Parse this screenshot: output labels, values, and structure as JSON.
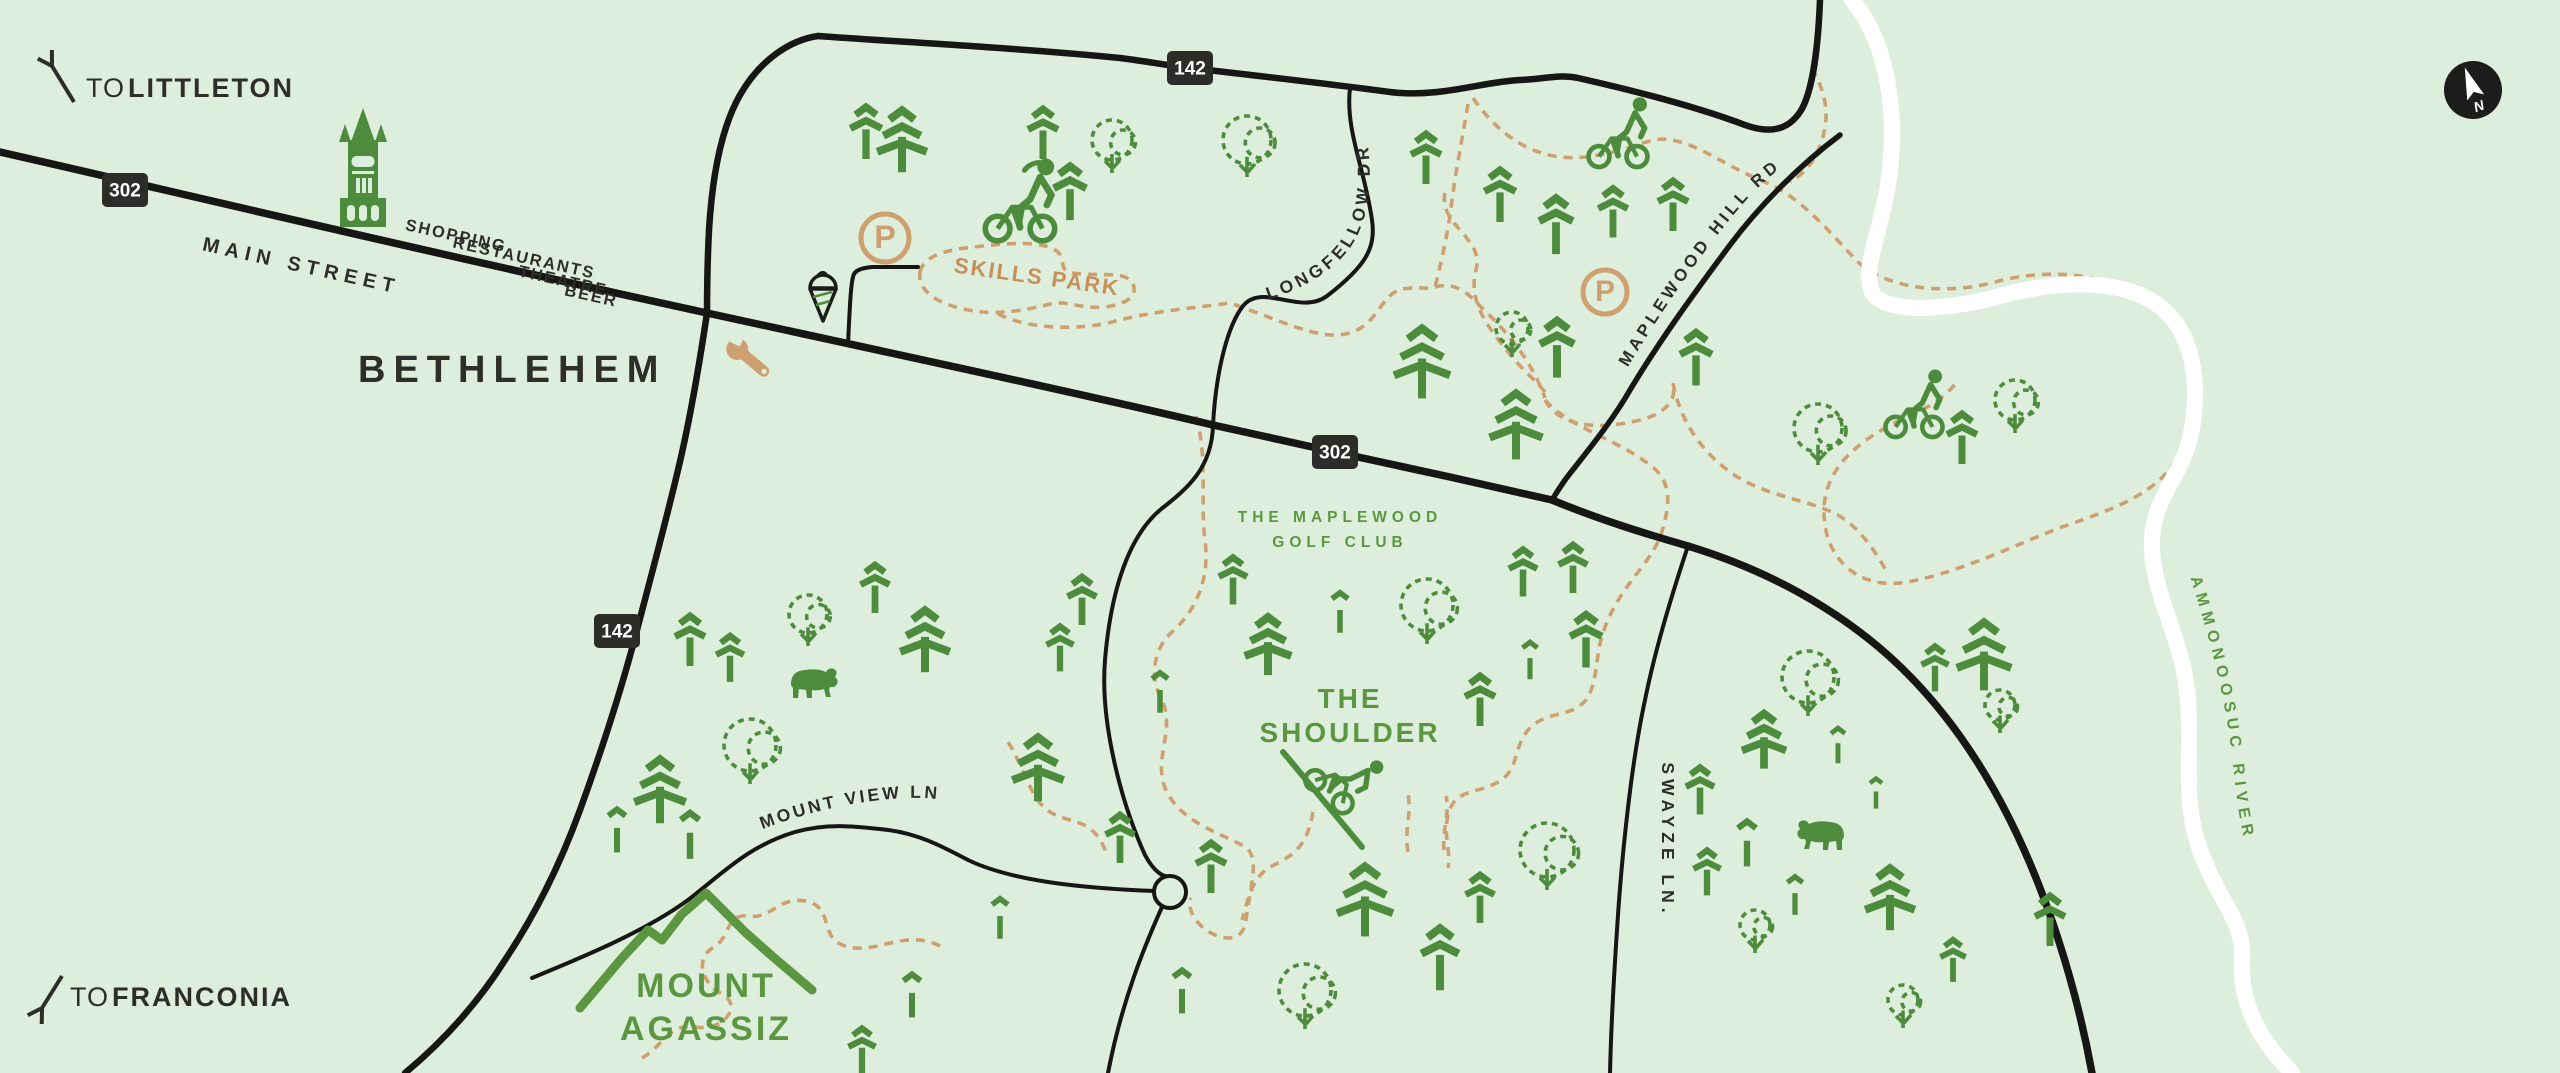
{
  "map": {
    "colors": {
      "background": "#deeedd",
      "road": "#161614",
      "trail": "#cfa06f",
      "river": "#ffffff",
      "tree_green": "#4d8c3c",
      "label_green": "#5b9740",
      "tan_icon": "#cfa06f",
      "skills_text": "#c79058",
      "dark_text": "#2d2d2a",
      "badge_bg": "#2c2c29",
      "badge_text": "#ffffff"
    },
    "directions": [
      {
        "id": "littleton",
        "prefix": "TO",
        "name": "LITTLETON",
        "x": 86,
        "y": 97,
        "arrow": {
          "x1": 74,
          "y1": 102,
          "x2": 52,
          "y2": 66,
          "dir": "up-left"
        }
      },
      {
        "id": "franconia",
        "prefix": "TO",
        "name": "FRANCONIA",
        "x": 70,
        "y": 1006,
        "arrow": {
          "x1": 62,
          "y1": 976,
          "x2": 42,
          "y2": 1008,
          "dir": "down-left"
        }
      }
    ],
    "town": {
      "name": "BETHLEHEM",
      "x": 358,
      "y": 382
    },
    "street_words": [
      {
        "text": "MAIN STREET",
        "x": 300,
        "y": 272,
        "rot": 12.5,
        "size": 20,
        "ls": 6
      },
      {
        "text": "SHOPPING",
        "x": 455,
        "y": 241,
        "rot": 12.5,
        "size": 16.5,
        "ls": 2
      },
      {
        "text": "RESTAURANTS",
        "x": 523,
        "y": 263,
        "rot": 12.5,
        "size": 16.5,
        "ls": 2
      },
      {
        "text": "THEATRE",
        "x": 562,
        "y": 286,
        "rot": 12.5,
        "size": 16.5,
        "ls": 2
      },
      {
        "text": "BEER",
        "x": 590,
        "y": 301,
        "rot": 12.5,
        "size": 16.5,
        "ls": 2
      }
    ],
    "route_badges": [
      {
        "route": "302",
        "x": 125,
        "y": 190
      },
      {
        "route": "142",
        "x": 1190,
        "y": 68
      },
      {
        "route": "302",
        "x": 1335,
        "y": 452
      },
      {
        "route": "142",
        "x": 617,
        "y": 631
      }
    ],
    "roads": {
      "main_street_302": {
        "path": "M 0,152 C 150,186 400,246 707,313 C 900,355 1100,398 1213,425 C 1280,440 1380,462 1450,477 C 1490,486 1525,494 1552,500",
        "w": 7.5
      },
      "route_302_south": {
        "path": "M 1552,500 C 1600,520 1650,535 1688,546 C 1760,568 1820,600 1870,640 C 1930,688 1975,750 2010,820 C 2045,890 2075,980 2092,1073",
        "w": 7.5
      },
      "route_142_top": {
        "path": "M 818,36 C 900,42 1020,48 1120,58 C 1145,61 1170,66 1190,68 C 1260,76 1330,84 1390,92 C 1440,98 1480,82 1520,80 C 1545,79 1560,74 1578,78 C 1640,92 1700,108 1745,125 C 1770,134 1788,130 1800,112 C 1812,94 1818,50 1820,0",
        "w": 6.5
      },
      "route_142_west": {
        "path": "M 818,36 C 790,40 760,60 740,95 C 720,130 712,180 709,230 C 707,270 707,290 707,313",
        "w": 6.5
      },
      "route_142_south": {
        "path": "M 707,313 C 700,360 690,420 678,470 C 665,525 650,580 637,630 C 620,695 600,755 580,810 C 560,865 535,915 505,960 C 480,1000 445,1040 405,1073",
        "w": 6.5
      },
      "maplewood_hill_rd": {
        "path": "M 1840,135 C 1800,165 1760,205 1730,245 C 1695,292 1660,340 1630,390 C 1610,425 1580,460 1565,480 C 1558,490 1555,495 1552,500",
        "w": 5.5
      },
      "longfellow_dr": {
        "path": "M 1350,88 C 1345,130 1365,170 1372,220 C 1376,248 1366,266 1327,296 C 1300,316 1262,282 1243,306 C 1228,325 1216,370 1213,425 C 1212,470 1185,490 1160,510 C 1125,540 1110,600 1105,660 C 1100,720 1120,800 1145,855 C 1154,872 1164,878 1170,876",
        "w": 4
      },
      "swayze_ln": {
        "path": "M 1688,546 C 1670,600 1655,650 1645,700 C 1632,760 1622,850 1617,930 C 1613,990 1611,1030 1610,1073",
        "w": 4
      },
      "mount_view_ln": {
        "path": "M 532,978 C 570,962 640,935 688,900 C 722,874 748,846 795,832 C 830,822 860,827 888,830 C 920,834 945,848 968,860 C 1010,880 1075,888 1154,891",
        "w": 4
      },
      "culdesac_south": {
        "path": "M 1162,907 C 1145,945 1122,1000 1108,1073",
        "w": 4
      },
      "parking_access": {
        "path": "M 848,345 C 850,300 851,285 853,277 C 854,270 862,268 872,267 L 918,267",
        "w": 4
      }
    },
    "culdesac": {
      "x": 1170,
      "y": 892,
      "r": 16
    },
    "river": {
      "name": "AMMONOOSUC RIVER",
      "path": "M 1852,0 C 1890,45 1898,120 1888,185 C 1880,235 1862,268 1872,292 C 1885,315 1950,310 2000,296 C 2060,280 2120,278 2158,305 C 2198,334 2200,395 2190,438 C 2180,480 2150,500 2152,548 C 2154,600 2184,640 2188,700 C 2192,760 2182,800 2200,850 C 2220,905 2245,920 2242,962 C 2240,1010 2265,1045 2292,1073",
      "w": 16,
      "label_path": "M 2178,540 C 2206,625 2226,690 2234,775 C 2240,830 2248,858 2256,880"
    },
    "road_label_paths": {
      "longfellow": {
        "text": "LONGFELLOW DR",
        "path": "M 1238,308 C 1295,295 1338,272 1356,238 C 1372,208 1374,165 1362,112",
        "size": 17.5,
        "ls": 4
      },
      "maplewood": {
        "text": "MAPLEWOOD HILL RD",
        "path": "M 1593,428 C 1630,360 1688,266 1748,198 C 1778,166 1806,148 1844,136",
        "size": 17,
        "ls": 4
      },
      "mountview": {
        "text": "MOUNT VIEW LN",
        "path": "M 726,845 C 782,818 845,801 905,798 C 935,797 955,801 978,808",
        "size": 17.5,
        "ls": 3
      },
      "swayze": {
        "text": "SWAYZE LN.",
        "x": 1662,
        "y": 840,
        "rot": 90,
        "size": 17.5,
        "ls": 5
      }
    },
    "pois": {
      "skills_park": {
        "label": "SKILLS PARK",
        "x": 1036,
        "y": 284,
        "rot": 8,
        "size": 22,
        "loop": "M 920,272 C 924,256 944,250 974,247 C 1008,243 1044,240 1058,252 C 1066,260 1058,270 1072,273 C 1102,277 1126,270 1133,284 C 1138,296 1126,305 1104,307 C 1080,309 1066,300 1050,304 C 1028,310 998,315 974,311 C 948,307 917,296 920,272 Z"
      },
      "golf_club": {
        "line1": "THE MAPLEWOOD",
        "line2": "GOLF CLUB",
        "x": 1340,
        "y": 522,
        "y2": 547,
        "size": 15.5
      },
      "shoulder": {
        "line1": "THE",
        "line2": "SHOULDER",
        "x": 1350,
        "y": 708,
        "y2": 742,
        "size": 28
      },
      "mount_agassiz": {
        "line1": "MOUNT",
        "line2": "AGASSIZ",
        "x": 706,
        "y": 997,
        "y2": 1040,
        "size": 34,
        "ridge": "M 580,1008 L 622,958 L 648,930 L 662,940 L 682,914 L 706,893 L 745,932 L 772,956 L 812,990"
      }
    },
    "trails": [
      "M 998,314 C 1030,330 1080,330 1112,322 C 1148,312 1192,308 1230,303 C 1280,320 1318,340 1345,334 C 1378,328 1380,294 1402,289 C 1420,286 1428,290 1435,287 C 1458,281 1470,296 1480,306 C 1502,327 1530,356 1545,398",
      "M 1468,104 C 1462,140 1456,170 1452,200 C 1448,235 1441,262 1435,287",
      "M 1473,98 C 1502,140 1540,162 1585,157 C 1630,152 1650,135 1672,140 C 1700,145 1728,167 1760,180 C 1798,194 1826,228 1856,260 C 1880,286 1940,297 1995,282 C 2058,265 2120,277 2158,307 C 2194,337 2196,397 2186,437 C 2172,489 2120,507 2062,527 C 2014,545 1962,572 1907,582 C 1857,591 1822,557 1824,507 C 1827,463 1864,437 1907,417 C 1937,404 1950,392 1958,380",
      "M 1545,400 C 1560,428 1600,430 1640,420 C 1672,412 1676,395 1673,383 C 1680,420 1700,450 1730,472 C 1762,495 1800,498 1832,512 C 1858,524 1876,552 1888,574",
      "M 1445,193 C 1438,225 1485,238 1476,270 C 1468,300 1486,325 1508,352 C 1524,372 1538,382 1548,396",
      "M 1812,68 C 1826,94 1830,114 1822,140 C 1814,166 1800,176 1790,182",
      "M 1196,416 C 1208,458 1200,500 1205,540 C 1210,580 1196,610 1172,632 C 1152,650 1150,680 1162,700 C 1176,730 1152,760 1166,790 C 1180,820 1212,830 1242,845 C 1262,854 1250,886 1246,920 C 1243,942 1226,940 1213,934 C 1196,926 1186,908 1191,898",
      "M 1313,812 C 1308,838 1302,852 1272,866 C 1252,876 1248,900 1242,920",
      "M 1408,852 C 1404,830 1412,814 1408,794",
      "M 1444,850 C 1442,830 1450,814 1446,796",
      "M 1545,400 C 1572,430 1622,440 1656,470 C 1673,487 1668,510 1663,528 C 1655,560 1625,580 1608,620 C 1593,652 1600,680 1586,700 C 1571,718 1548,710 1530,728 C 1513,745 1520,768 1500,781 C 1478,794 1458,789 1450,809 C 1441,833 1452,852 1448,868",
      "M 940,946 C 905,928 875,956 845,946 C 818,938 835,906 805,901 C 778,896 772,920 748,916 C 726,913 730,938 714,947 C 694,958 702,984 722,994 C 744,1006 722,1032 696,1027 C 670,1022 662,1047 642,1058",
      "M 1008,742 C 1020,760 1028,788 1040,803 C 1052,818 1068,818 1082,824 C 1096,830 1102,842 1106,852"
    ],
    "parking": [
      {
        "letter": "P",
        "x": 885,
        "y": 238,
        "r": 24
      },
      {
        "letter": "P",
        "x": 1605,
        "y": 292,
        "r": 22
      }
    ],
    "amenities": {
      "church": {
        "x": 363,
        "y": 170
      },
      "ice_cream": {
        "x": 823,
        "y": 293
      },
      "wrench": {
        "x": 748,
        "y": 358,
        "rot": 40
      },
      "compass": {
        "letter": "N",
        "x": 2473,
        "y": 90,
        "r": 29,
        "rot": -20
      }
    },
    "cyclists": [
      {
        "id": "skills-park-cyclist",
        "x": 1020,
        "y": 242,
        "scale": 1.12,
        "rot": 0,
        "ponytail": true
      },
      {
        "id": "north-trail-cyclist",
        "x": 1618,
        "y": 168,
        "scale": 0.95,
        "rot": 0,
        "ponytail": false
      },
      {
        "id": "maplewood-cyclist",
        "x": 1914,
        "y": 438,
        "scale": 0.92,
        "rot": 0,
        "ponytail": false
      },
      {
        "id": "shoulder-downhill-cyclist",
        "x": 1322,
        "y": 800,
        "scale": 0.9,
        "rot": 40,
        "ponytail": false,
        "slope": {
          "x1": 1283,
          "y1": 752,
          "x2": 1362,
          "y2": 847
        }
      }
    ],
    "bears": [
      {
        "x": 815,
        "y": 678,
        "flip": false
      },
      {
        "x": 1820,
        "y": 830,
        "flip": true
      }
    ],
    "trees": [
      [
        "p2",
        866,
        132,
        52
      ],
      [
        "p3",
        902,
        140,
        62
      ],
      [
        "p2",
        1043,
        133,
        50
      ],
      [
        "p2",
        1070,
        192,
        54
      ],
      [
        "d",
        1112,
        140,
        20
      ],
      [
        "d",
        1247,
        140,
        24
      ],
      [
        "p2",
        1426,
        158,
        50
      ],
      [
        "p2",
        1500,
        195,
        52
      ],
      [
        "p2",
        1556,
        225,
        56
      ],
      [
        "p2",
        1613,
        212,
        49
      ],
      [
        "p2",
        1673,
        205,
        50
      ],
      [
        "d",
        1512,
        328,
        16
      ],
      [
        "p2",
        1557,
        348,
        57
      ],
      [
        "p2",
        1696,
        358,
        53
      ],
      [
        "p3",
        1422,
        362,
        70
      ],
      [
        "p3",
        1516,
        425,
        66
      ],
      [
        "p2",
        1962,
        438,
        50
      ],
      [
        "d",
        2015,
        400,
        20
      ],
      [
        "d",
        1818,
        428,
        24
      ],
      [
        "p3",
        1984,
        655,
        68
      ],
      [
        "d",
        1808,
        677,
        26
      ],
      [
        "p2",
        1935,
        668,
        45
      ],
      [
        "d",
        2000,
        705,
        15
      ],
      [
        "p2",
        1233,
        580,
        47
      ],
      [
        "p3",
        1268,
        645,
        58
      ],
      [
        "p1",
        1340,
        612,
        40
      ],
      [
        "d",
        1427,
        605,
        26
      ],
      [
        "p2",
        1523,
        572,
        47
      ],
      [
        "p2",
        1573,
        568,
        48
      ],
      [
        "p2",
        1586,
        640,
        53
      ],
      [
        "p1",
        1530,
        660,
        37
      ],
      [
        "p2",
        1480,
        700,
        50
      ],
      [
        "p1",
        1160,
        692,
        40
      ],
      [
        "p2",
        690,
        640,
        50
      ],
      [
        "p2",
        730,
        658,
        46
      ],
      [
        "d",
        808,
        614,
        19
      ],
      [
        "p2",
        875,
        588,
        48
      ],
      [
        "p3",
        925,
        640,
        62
      ],
      [
        "d",
        750,
        745,
        26
      ],
      [
        "p3",
        660,
        790,
        64
      ],
      [
        "p1",
        617,
        830,
        43
      ],
      [
        "p1",
        690,
        835,
        46
      ],
      [
        "p3",
        1038,
        768,
        64
      ],
      [
        "p2",
        1082,
        600,
        48
      ],
      [
        "p2",
        1060,
        648,
        45
      ],
      [
        "p2",
        1120,
        838,
        48
      ],
      [
        "p2",
        1211,
        867,
        50
      ],
      [
        "p1",
        1182,
        991,
        43
      ],
      [
        "p3",
        1365,
        900,
        70
      ],
      [
        "d",
        1305,
        990,
        26
      ],
      [
        "p2",
        1440,
        958,
        62
      ],
      [
        "p2",
        1480,
        898,
        48
      ],
      [
        "d",
        1547,
        850,
        27
      ],
      [
        "p1",
        912,
        995,
        43
      ],
      [
        "p2",
        862,
        1050,
        45
      ],
      [
        "p1",
        1000,
        918,
        40
      ],
      [
        "p3",
        1764,
        740,
        55
      ],
      [
        "p1",
        1838,
        745,
        35
      ],
      [
        "p2",
        1700,
        790,
        47
      ],
      [
        "p1",
        1876,
        793,
        30
      ],
      [
        "p1",
        1747,
        843,
        45
      ],
      [
        "p2",
        1707,
        872,
        45
      ],
      [
        "p1",
        1795,
        895,
        38
      ],
      [
        "d",
        1755,
        925,
        15
      ],
      [
        "p3",
        1890,
        898,
        62
      ],
      [
        "p2",
        1953,
        960,
        42
      ],
      [
        "d",
        1903,
        1000,
        15
      ],
      [
        "p2",
        2050,
        920,
        50
      ]
    ]
  }
}
